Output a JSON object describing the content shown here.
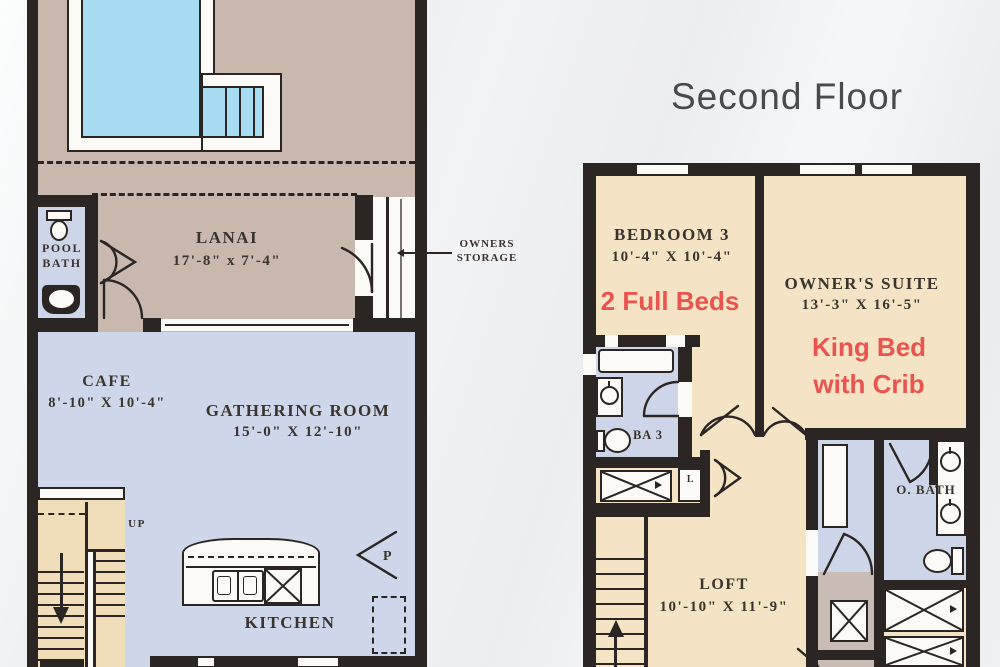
{
  "title": "Second Floor",
  "callout": {
    "line1": "OWNERS",
    "line2": "STORAGE"
  },
  "first_floor": {
    "pool_bath": {
      "line1": "POOL",
      "line2": "BATH"
    },
    "lanai": {
      "name": "LANAI",
      "dims": "17'-8\" x 7'-4\""
    },
    "cafe": {
      "name": "CAFE",
      "dims": "8'-10\" X 10'-4\""
    },
    "gathering_room": {
      "name": "GATHERING ROOM",
      "dims": "15'-0\" X 12'-10\""
    },
    "kitchen": {
      "name": "KITCHEN"
    },
    "pantry": {
      "name": "P"
    },
    "stairs": {
      "up": "UP"
    }
  },
  "second_floor": {
    "bedroom_3": {
      "name": "BEDROOM 3",
      "dims": "10'-4\" X 10'-4\"",
      "feature": "2 Full Beds"
    },
    "owners_suite": {
      "name": "OWNER'S SUITE",
      "dims": "13'-3\" X 16'-5\"",
      "feature_line1": "King Bed",
      "feature_line2": "with Crib"
    },
    "bath_3": {
      "name": "BA 3"
    },
    "owners_bath": {
      "name": "O. BATH"
    },
    "loft": {
      "name": "LOFT",
      "dims": "10'-10\" X 11'-9\""
    },
    "linen": {
      "name": "L"
    }
  },
  "colors": {
    "wall": "#2B2523",
    "pool_water": "#A8DCF2",
    "deck": "#C9B8AE",
    "first_floor_interior": "#CDD7E9",
    "bedroom_cream": "#F4E3C4",
    "bath_blue": "#CCD6E8",
    "laundry_tan": "#C9BCB4",
    "stair_tan": "#F0DDBA",
    "accent_red": "#E9544F",
    "text_dark": "#3A332E",
    "background": "#EFF1F2"
  }
}
